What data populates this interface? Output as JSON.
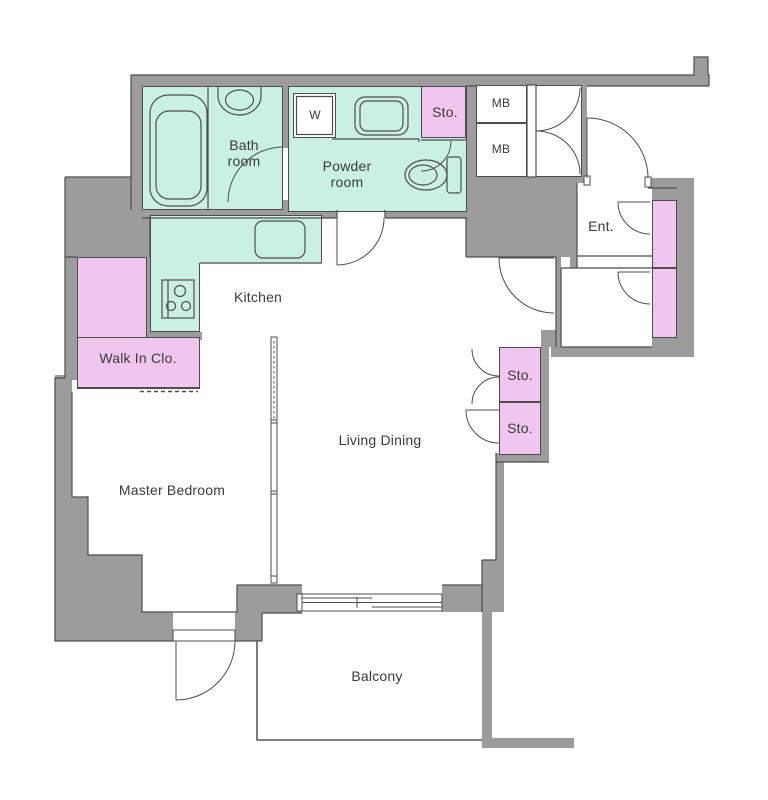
{
  "plan": {
    "title": "Apartment floor plan",
    "labels": {
      "bath_room": "Bath\nroom",
      "washer": "W",
      "powder_room": "Powder\nroom",
      "storage_top": "Sto.",
      "meter_box_1": "MB",
      "meter_box_2": "MB",
      "entrance": "Ent.",
      "kitchen": "Kitchen",
      "walk_in_closet": "Walk In Clo.",
      "storage_1": "Sto.",
      "storage_2": "Sto.",
      "living_dining": "Living Dining",
      "master_bedroom": "Master Bedroom",
      "balcony": "Balcony"
    },
    "colors": {
      "wall": "#9c9c9c",
      "wet_area": "#c9f0e3",
      "storage": "#f1c6ee",
      "outline": "#4d4d4d",
      "text": "#3b3b3b",
      "floor": "#ffffff"
    }
  }
}
